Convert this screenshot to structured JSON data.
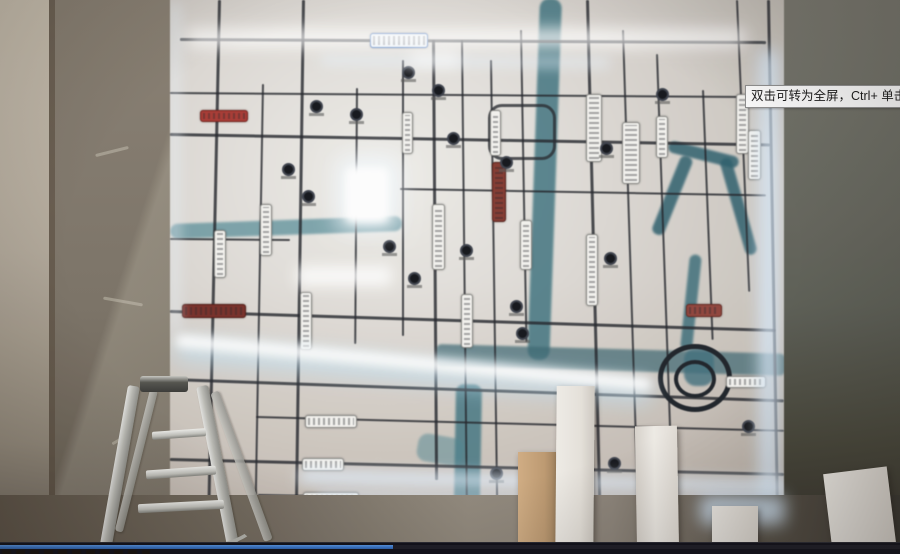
{
  "player": {
    "tooltip_text": "双击可转为全屏，Ctrl+ 单击可转为",
    "progress": {
      "value_percent": 43.7,
      "played_color": "#3b79cf",
      "track_color": "#1d1d27",
      "bar_color": "#10101a"
    }
  },
  "palette": {
    "map_surface": "#ddd9d3",
    "road_dark": "#26282e",
    "river_teal": "#35707e",
    "led_glow": "#d8ebfd",
    "label_red": "#b03a33",
    "label_maroon": "#8a3a30",
    "highway_blue": "#3a6fc0",
    "wall_brown": "#7d7466",
    "ladder_silver": "#c8c8c2"
  },
  "map": {
    "roads_v": [
      [
        48,
        8,
        500,
        1.2,
        3
      ],
      [
        92,
        92,
        416,
        1.0,
        2
      ],
      [
        132,
        8,
        500,
        0.8,
        3
      ],
      [
        186,
        96,
        256,
        0.4,
        2
      ],
      [
        232,
        68,
        276,
        0,
        2
      ],
      [
        262,
        48,
        440,
        -0.4,
        3
      ],
      [
        291,
        48,
        462,
        -0.6,
        2
      ],
      [
        320,
        68,
        444,
        -0.8,
        2
      ],
      [
        350,
        38,
        312,
        -1.0,
        2
      ],
      [
        416,
        8,
        506,
        -1.4,
        3
      ],
      [
        452,
        38,
        476,
        -1.8,
        2
      ],
      [
        486,
        62,
        400,
        -2.0,
        2
      ],
      [
        532,
        98,
        250,
        -2.2,
        2
      ],
      [
        566,
        8,
        292,
        -2.4,
        2
      ],
      [
        597,
        8,
        508,
        -1.0,
        3
      ]
    ],
    "roads_h": [
      [
        10,
        46,
        586,
        0.3,
        3
      ],
      [
        0,
        100,
        596,
        0.4,
        2
      ],
      [
        0,
        141,
        600,
        1.0,
        3
      ],
      [
        230,
        196,
        366,
        1.0,
        2
      ],
      [
        0,
        318,
        606,
        1.8,
        3
      ],
      [
        0,
        386,
        614,
        2.0,
        3
      ],
      [
        86,
        424,
        528,
        1.5,
        2
      ],
      [
        0,
        466,
        614,
        1.4,
        3
      ],
      [
        88,
        502,
        518,
        1.0,
        2
      ],
      [
        0,
        246,
        120,
        0.5,
        2
      ]
    ],
    "rivers": [
      [
        370,
        6,
        22,
        362,
        2,
        "#35707e",
        0.8,
        10
      ],
      [
        286,
        392,
        26,
        126,
        1,
        "#3a7482",
        0.8,
        8
      ],
      [
        266,
        352,
        350,
        22,
        1.6,
        "#3a6873",
        0.7,
        6
      ],
      [
        0,
        232,
        232,
        15,
        -2,
        "#4f8b98",
        0.7,
        8
      ],
      [
        500,
        148,
        72,
        12,
        14,
        "#2c6170",
        0.85,
        6
      ],
      [
        512,
        162,
        13,
        84,
        22,
        "#2c6170",
        0.85,
        6
      ],
      [
        549,
        168,
        12,
        100,
        -16,
        "#2c6170",
        0.85,
        6
      ],
      [
        520,
        262,
        12,
        96,
        6,
        "#336b79",
        0.8,
        6
      ],
      [
        514,
        356,
        30,
        38,
        0,
        "#3f7180",
        0.8,
        12
      ],
      [
        250,
        440,
        46,
        28,
        10,
        "#4e8793",
        0.5,
        10
      ]
    ],
    "glows": [
      [
        16,
        38,
        560,
        16,
        0,
        "#ffffff",
        8,
        0.9
      ],
      [
        150,
        64,
        290,
        9,
        0.5,
        "#eaf4ff",
        6,
        0.6
      ],
      [
        240,
        58,
        50,
        18,
        0,
        "#ffffff",
        7,
        0.55
      ],
      [
        168,
        166,
        60,
        72,
        0,
        "#f4faff",
        12,
        0.95
      ],
      [
        176,
        176,
        42,
        54,
        0,
        "#ffffff",
        4,
        1
      ],
      [
        590,
        58,
        18,
        452,
        0,
        "#d8ebfd",
        8,
        0.9
      ],
      [
        6,
        346,
        478,
        22,
        5.3,
        "#bfe2f6",
        10,
        0.65
      ],
      [
        6,
        342,
        478,
        13,
        5.3,
        "#ffffff",
        5,
        0.95
      ],
      [
        128,
        478,
        492,
        13,
        1.2,
        "#e2f1ff",
        7,
        0.85
      ],
      [
        148,
        500,
        468,
        8,
        1.0,
        "#dcecff",
        6,
        0.7
      ],
      [
        126,
        274,
        96,
        20,
        0,
        "#ffffff",
        7,
        0.85
      ],
      [
        0,
        10,
        10,
        330,
        0,
        "#e8f2fc",
        6,
        0.5
      ]
    ],
    "plaques": [
      [
        200,
        41,
        56,
        13,
        "#eef4fb",
        "#3a6fc0"
      ],
      [
        30,
        118,
        46,
        10,
        "#b03a33",
        "#7c241f"
      ],
      [
        322,
        170,
        12,
        58,
        "#8a3a30",
        "#5e241d"
      ],
      [
        12,
        312,
        62,
        12,
        "#7e2f28",
        "#571d17"
      ],
      [
        516,
        312,
        34,
        11,
        "#96453c",
        "#6b2a23"
      ],
      [
        44,
        238,
        10,
        46,
        "#f3f2ee",
        "#8a8a86"
      ],
      [
        90,
        212,
        10,
        50,
        "#f3f2ee",
        "#8a8a86"
      ],
      [
        130,
        300,
        10,
        56,
        "#f3f2ee",
        "#8a8a86"
      ],
      [
        232,
        120,
        9,
        40,
        "#f3f2ee",
        "#8a8a86"
      ],
      [
        262,
        212,
        11,
        64,
        "#f3f2ee",
        "#8a8a86"
      ],
      [
        291,
        302,
        10,
        52,
        "#f3f2ee",
        "#8a8a86"
      ],
      [
        320,
        118,
        9,
        44,
        "#f3f2ee",
        "#8a8a86"
      ],
      [
        350,
        228,
        10,
        48,
        "#f3f2ee",
        "#8a8a86"
      ],
      [
        416,
        102,
        14,
        66,
        "#f3f2ee",
        "#8a8a86"
      ],
      [
        416,
        242,
        10,
        70,
        "#f3f2ee",
        "#8a8a86"
      ],
      [
        452,
        130,
        16,
        60,
        "#f3f2ee",
        "#8a8a86"
      ],
      [
        486,
        124,
        10,
        40,
        "#f3f2ee",
        "#8a8a86"
      ],
      [
        566,
        102,
        11,
        58,
        "#f3f2ee",
        "#8a8a86"
      ],
      [
        578,
        138,
        11,
        48,
        "#f3f2ee",
        "#8a8a86"
      ],
      [
        135,
        423,
        50,
        11,
        "#f3f2ee",
        "#8a8a86"
      ],
      [
        132,
        466,
        40,
        11,
        "#f3f2ee",
        "#8a8a86"
      ],
      [
        133,
        500,
        54,
        12,
        "#f3f2ee",
        "#8a8a86"
      ],
      [
        556,
        384,
        38,
        10,
        "#f3f2ee",
        "#8a8a86"
      ]
    ],
    "pois": [
      [
        140,
        108
      ],
      [
        180,
        116
      ],
      [
        232,
        74
      ],
      [
        112,
        171
      ],
      [
        132,
        198
      ],
      [
        213,
        248
      ],
      [
        238,
        280
      ],
      [
        277,
        140
      ],
      [
        290,
        252
      ],
      [
        330,
        164
      ],
      [
        340,
        308
      ],
      [
        346,
        335
      ],
      [
        430,
        150
      ],
      [
        434,
        260
      ],
      [
        572,
        428
      ],
      [
        438,
        465
      ],
      [
        320,
        475
      ],
      [
        262,
        92
      ],
      [
        486,
        96
      ]
    ],
    "spiral": {
      "outer": [
        488,
        352,
        64,
        58
      ],
      "inner": [
        504,
        368,
        34,
        30
      ]
    },
    "loop_road": [
      318,
      112,
      62,
      50
    ]
  },
  "foreground": {
    "ladder": {
      "cap": [
        140,
        376,
        48,
        16
      ],
      "legs": [
        [
          128,
          386,
          12,
          162,
          10,
          false
        ],
        [
          196,
          386,
          12,
          162,
          -11,
          false
        ],
        [
          210,
          392,
          9,
          158,
          -20,
          true
        ],
        [
          150,
          390,
          8,
          146,
          14,
          true
        ]
      ],
      "steps": [
        [
          152,
          430,
          54,
          8,
          -4
        ],
        [
          146,
          468,
          70,
          9,
          -4
        ],
        [
          138,
          502,
          86,
          9,
          -3
        ]
      ],
      "arc": [
        120,
        500,
        130,
        44,
        -4
      ]
    },
    "pillars": [
      [
        518,
        452,
        38,
        100,
        0,
        "linear-gradient(to right,#d4ad80 0%,#c19a6e 70%,#a5845c 100%)"
      ],
      [
        556,
        386,
        38,
        168,
        0.5,
        "linear-gradient(to right,#f0ede7 0%,#e6e2da 65%,#cfcac2 100%)"
      ],
      [
        636,
        426,
        42,
        128,
        -1,
        "linear-gradient(to right,#d8d3cb 0%,#efece6 45%,#e2ddd5 100%)"
      ],
      [
        712,
        506,
        46,
        48,
        0,
        "linear-gradient(to right,#ece9e3 0%,#dcd7cf 100%)"
      ],
      [
        828,
        470,
        64,
        84,
        -7,
        "linear-gradient(to right,#efece6 0%,#ddd8d0 100%)"
      ]
    ]
  }
}
